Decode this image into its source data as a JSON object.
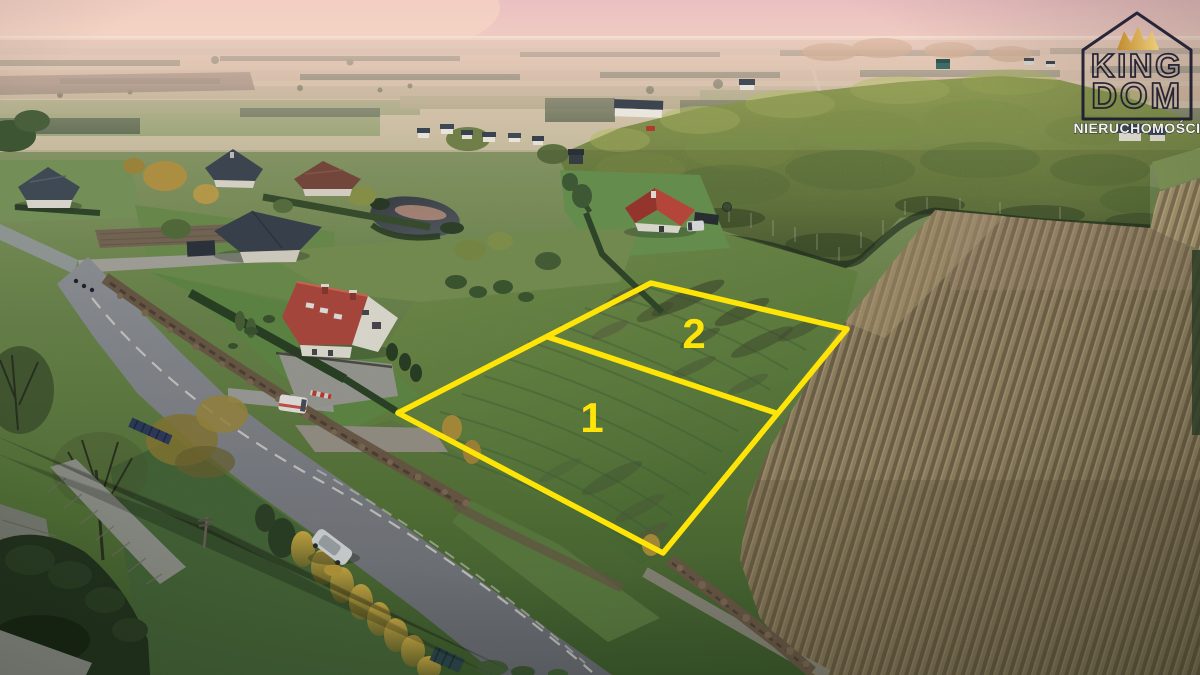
{
  "scene": {
    "kind": "aerial drone photograph at dusk",
    "subject": "two building plots outlined for sale on a green field",
    "setting": "rural road with houses and gardens on the left, birch forest and ripe corn field on the right, hazy pink sunset horizon"
  },
  "plot_overlay": {
    "outline_color": "#FFE408",
    "plots": [
      {
        "number": "1"
      },
      {
        "number": "2"
      }
    ]
  },
  "watermark_logo": {
    "brand_line1": "KING",
    "brand_line2": "DOM",
    "subtitle": "NIERUCHOMOŚCI",
    "outline_color": "#1A1A30",
    "crown_gold_dark": "#C08A25",
    "crown_gold_light": "#F2D078",
    "subtitle_color": "#FFFFFF"
  }
}
